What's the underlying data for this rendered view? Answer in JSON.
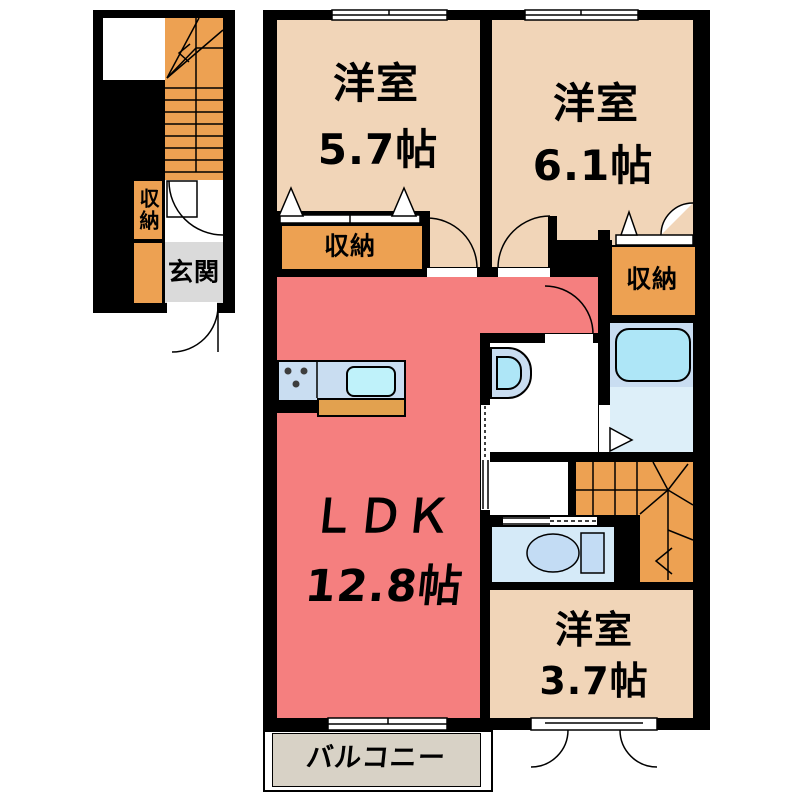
{
  "plan_title": "2-story apartment floor plan",
  "colors": {
    "wall": "#000000",
    "room": "#F1D5B8",
    "ldk": "#F57F7F",
    "storage": "#EDA152",
    "balcony": "#D8D2C6",
    "genkan": "#DADADA",
    "counter": "#E2A14F",
    "panel": "#C9DDF1",
    "cyan": "#AEE6F7",
    "sinkfill": "#BFF2FA",
    "bathfloor": "#DDEFF9",
    "toiletroom": "#D5EAF8",
    "toiletfill": "#C3DCF4"
  },
  "labels": {
    "room_57": {
      "name": "洋室",
      "size": "5.7帖"
    },
    "room_61": {
      "name": "洋室",
      "size": "6.1帖"
    },
    "room_37": {
      "name": "洋室",
      "size": "3.7帖"
    },
    "ldk": {
      "name": "ＬＤＫ",
      "size": "12.8帖"
    },
    "closet_57": "収納",
    "closet_61": "収納",
    "closet_1f": "収納",
    "genkan": "玄関",
    "balcony": "バルコニー"
  },
  "fixtures": [
    "kitchen-sink",
    "stove-burners",
    "bathtub",
    "washbasin",
    "toilet",
    "stairs-1f",
    "stairs-2f"
  ]
}
